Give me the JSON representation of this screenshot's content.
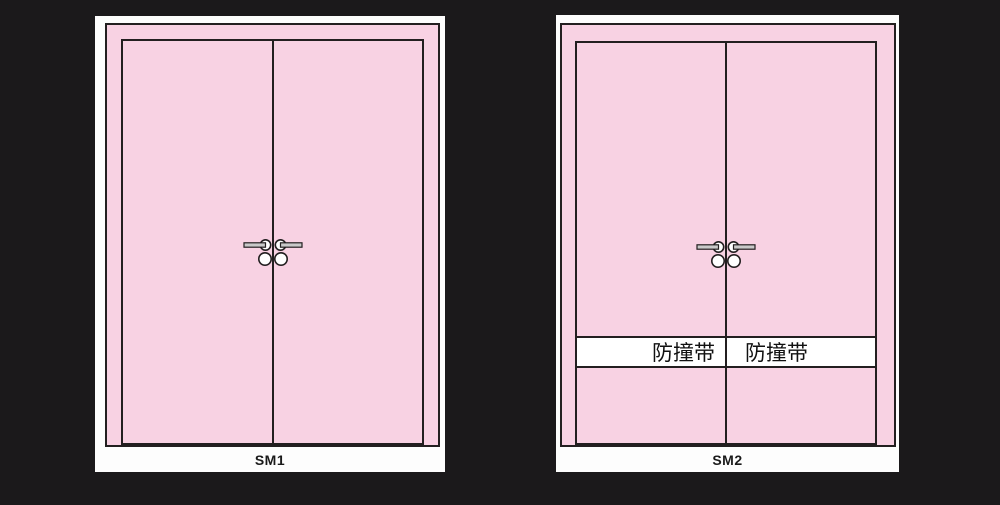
{
  "doors": [
    {
      "label": "SM1"
    },
    {
      "label": "SM2",
      "band": {
        "left_text": "防撞带",
        "right_text": "防撞带"
      }
    }
  ],
  "colors": {
    "background": "#1b191b",
    "card": "#fdfdfd",
    "door_pink": "#f8d2e3",
    "line": "#231f20",
    "handle_gray": "#c9c9c9",
    "band_white": "#ffffff",
    "label_text": "#1a1a1a"
  }
}
